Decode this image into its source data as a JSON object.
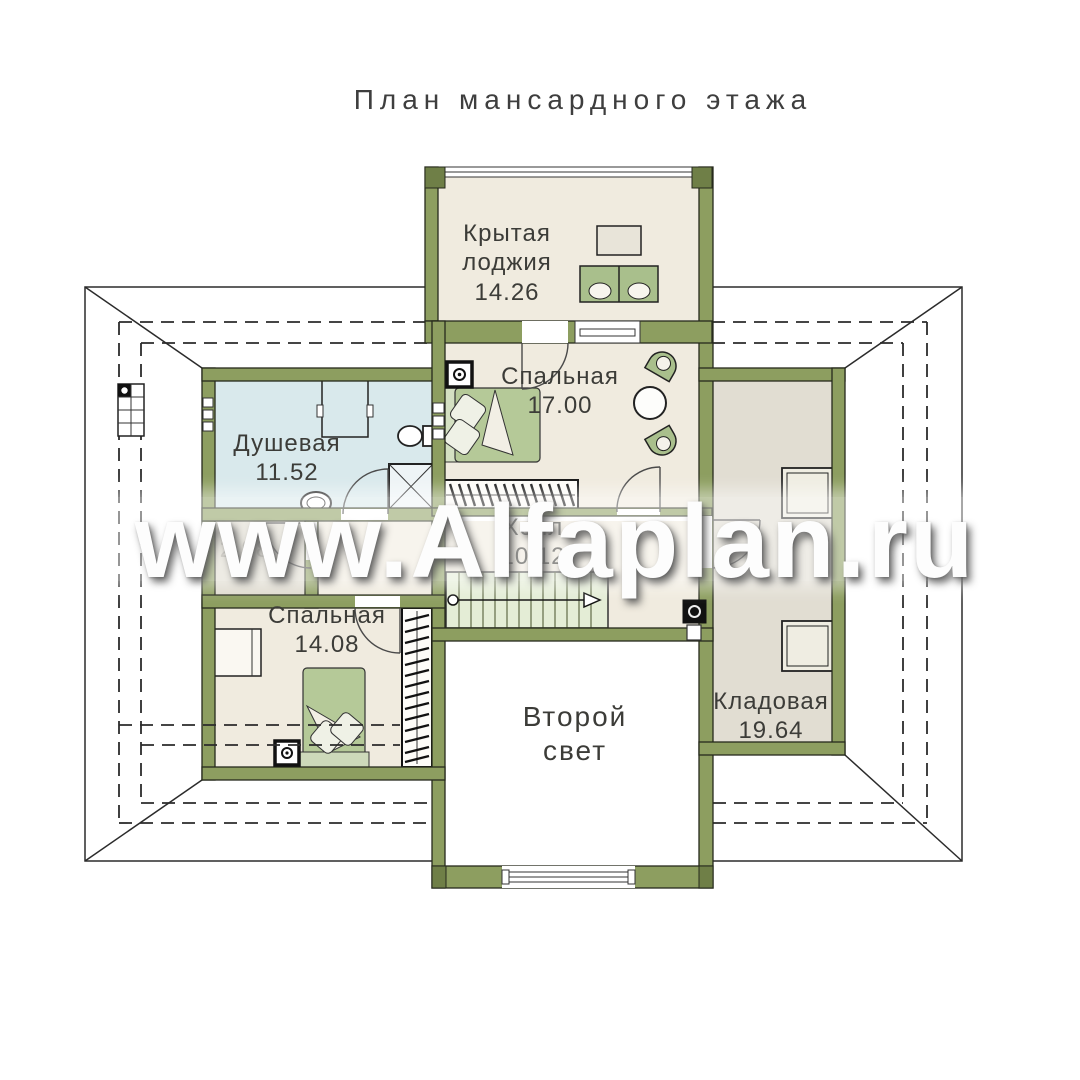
{
  "title": "План мансардного этажа",
  "watermark": "www.Alfaplan.ru",
  "rooms": {
    "loggia": {
      "name_line1": "Крытая",
      "name_line2": "лоджия",
      "area": "14.26"
    },
    "bedroom1": {
      "name": "Спальная",
      "area": "17.00"
    },
    "shower": {
      "name": "Душевая",
      "area": "11.52"
    },
    "closet": {
      "area": "2.98"
    },
    "hall": {
      "name": "Холл",
      "area": "10.12"
    },
    "bedroom2": {
      "name": "Спальная",
      "area": "14.08"
    },
    "storage": {
      "name": "Кладовая",
      "area": "19.64"
    },
    "void": {
      "name_line1": "Второй",
      "name_line2": "свет"
    }
  },
  "colors": {
    "wall": "#8d9e60",
    "wall_dark": "#6f7f47",
    "floor_cream": "#f0ebdf",
    "floor_shower": "#d9e9ec",
    "floor_closet": "#dedace",
    "floor_storage": "#e1ddd2",
    "stairs": "#e4edd6",
    "furniture_green": "#b5c998",
    "label_text": "#3c3c38",
    "watermark_text": "#fdfdfd"
  }
}
